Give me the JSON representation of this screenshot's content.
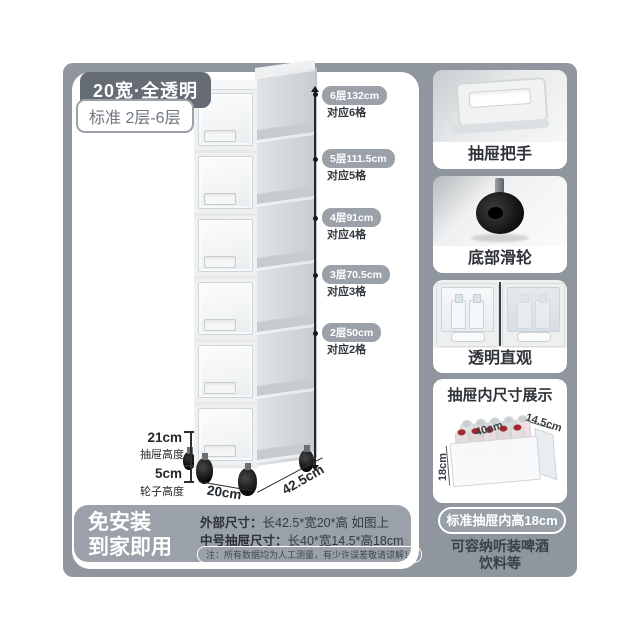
{
  "header": {
    "tag_primary": "20宽·全透明",
    "tag_secondary": "标准 2层-6层"
  },
  "levels": [
    {
      "badge": "6层132cm",
      "note": "对应6格"
    },
    {
      "badge": "5层111.5cm",
      "note": "对应5格"
    },
    {
      "badge": "4层91cm",
      "note": "对应4格"
    },
    {
      "badge": "3层70.5cm",
      "note": "对应3格"
    },
    {
      "badge": "2层50cm",
      "note": "对应2格"
    }
  ],
  "dimensions": {
    "drawer_height_value": "21cm",
    "drawer_height_label": "抽屉高度",
    "wheel_height_value": "5cm",
    "wheel_height_label": "轮子高度",
    "width_front": "20cm",
    "depth_side": "42.5cm"
  },
  "info_band": {
    "slogan_line1": "免安装",
    "slogan_line2": "到家即用",
    "outer_label": "外部尺寸：",
    "outer_value": "长42.5*宽20*高 如图上",
    "drawer_label": "中号抽屉尺寸：",
    "drawer_value": "长40*宽14.5*高18cm",
    "note": "注：所有数据均为人工测量，有少许误差敬请谅解！"
  },
  "sidebar": {
    "card_handle_label": "抽屉把手",
    "card_wheel_label": "底部滑轮",
    "card_transparent_label": "透明直观",
    "dims_card": {
      "title": "抽屉内尺寸展示",
      "dim_length": "40cm",
      "dim_width": "14.5cm",
      "dim_height": "18cm"
    },
    "inner_height_badge": "标准抽屉内高18cm",
    "caption_line1": "可容纳听装啤酒",
    "caption_line2": "饮料等"
  },
  "colors": {
    "frame_bg": "#8f969d",
    "band_bg": "#9aa1a8",
    "level_pill_bg": "#9aa1a9",
    "dark_badge_bg": "#656c73",
    "text_dark": "#2e343a",
    "can_top_red": "#a8242e"
  }
}
